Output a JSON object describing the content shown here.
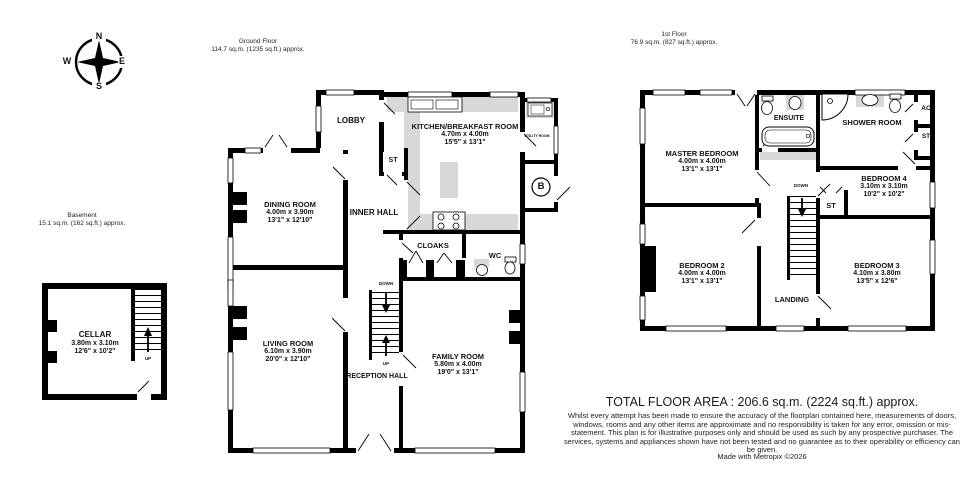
{
  "compass": {
    "n": "N",
    "e": "E",
    "s": "S",
    "w": "W"
  },
  "floor_titles": {
    "ground": {
      "name": "Ground Floor",
      "area": "114.7 sq.m. (1235 sq.ft.) approx."
    },
    "first": {
      "name": "1st Floor",
      "area": "76.9 sq.m. (827 sq.ft.) approx."
    },
    "basement": {
      "name": "Basement",
      "area": "15.1 sq.m. (162 sq.ft.) approx."
    }
  },
  "rooms": {
    "cellar": {
      "name": "CELLAR",
      "metric": "3.80m  x 3.10m",
      "imperial": "12'6\"  x 10'2\""
    },
    "lobby": {
      "name": "LOBBY"
    },
    "kitchen": {
      "name": "KITCHEN/BREAKFAST ROOM",
      "metric": "4.70m  x 4.00m",
      "imperial": "15'5\"  x 13'1\""
    },
    "utility": {
      "name": "UTILITY ROOM"
    },
    "st_ground": {
      "name": "ST"
    },
    "dining": {
      "name": "DINING ROOM",
      "metric": "4.00m  x 3.90m",
      "imperial": "13'1\"  x 12'10\""
    },
    "inner_hall": {
      "name": "INNER HALL"
    },
    "cloaks": {
      "name": "CLOAKS"
    },
    "wc": {
      "name": "WC"
    },
    "living": {
      "name": "LIVING ROOM",
      "metric": "6.10m  x 3.90m",
      "imperial": "20'0\"  x 12'10\""
    },
    "reception_hall": {
      "name": "RECEPTION HALL"
    },
    "family": {
      "name": "FAMILY ROOM",
      "metric": "5.80m  x 4.00m",
      "imperial": "19'0\"  x 13'1\""
    },
    "master": {
      "name": "MASTER BEDROOM",
      "metric": "4.00m  x 4.00m",
      "imperial": "13'1\"  x 13'1\""
    },
    "ensuite": {
      "name": "ENSUITE"
    },
    "shower": {
      "name": "SHOWER ROOM"
    },
    "ac": {
      "name": "AC"
    },
    "st_airing": {
      "name": "ST"
    },
    "st_landing": {
      "name": "ST"
    },
    "bedroom4": {
      "name": "BEDROOM 4",
      "metric": "3.10m  x 3.10m",
      "imperial": "10'2\"  x 10'2\""
    },
    "bedroom2": {
      "name": "BEDROOM 2",
      "metric": "4.00m  x 4.00m",
      "imperial": "13'1\"  x 13'1\""
    },
    "bedroom3": {
      "name": "BEDROOM 3",
      "metric": "4.10m  x 3.80m",
      "imperial": "13'5\"  x 12'6\""
    },
    "landing": {
      "name": "LANDING"
    }
  },
  "stairs": {
    "up": "UP",
    "down": "DOWN"
  },
  "boiler": {
    "label": "B"
  },
  "footer": {
    "total": "TOTAL FLOOR AREA : 206.6 sq.m. (2224 sq.ft.) approx.",
    "disclaimer": "Whilst every attempt has been made to ensure the accuracy of the floorplan contained here, measurements of doors, windows, rooms and any other items are approximate and no responsibility is taken for any error, omission or mis-statement. This plan is for illustrative purposes only and should be used as such by any prospective purchaser. The services, systems and appliances shown have not been tested and no guarantee as to their operability or efficiency can be given.",
    "credit": "Made with Metropix ©2026"
  },
  "colors": {
    "wall": "#000000",
    "fixture": "#d8d8d8",
    "background": "#ffffff"
  }
}
